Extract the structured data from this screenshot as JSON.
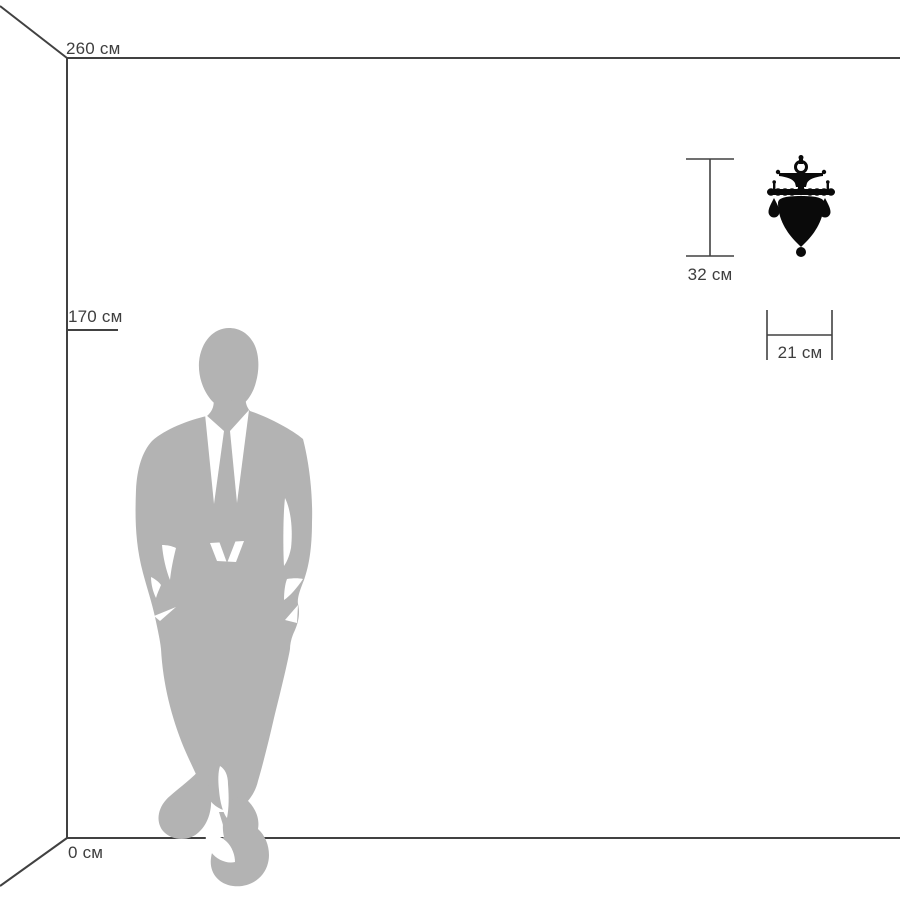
{
  "diagram": {
    "type": "product-scale-diagram",
    "wall": {
      "ceiling_height_label": "260 см",
      "floor_label": "0 см"
    },
    "person": {
      "height_label": "170 см",
      "description": "gray silhouette of a man in a suit, hands in pockets, ankles crossed"
    },
    "product": {
      "kind": "wall-sconce",
      "height_label": "32 см",
      "width_label": "21 см"
    },
    "colors": {
      "line": "#414141",
      "text": "#3e3e3e",
      "silhouette": "#b3b3b3",
      "product": "#0a0a0a",
      "background": "#ffffff"
    }
  }
}
